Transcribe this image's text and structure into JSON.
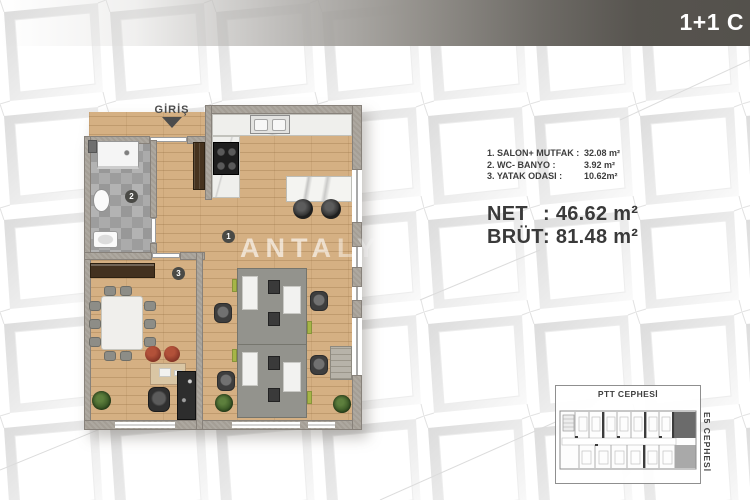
{
  "header": {
    "title": "1+1 C"
  },
  "plan": {
    "entrance_label": "GİRİŞ",
    "watermark": "ANTALYA",
    "markers": [
      {
        "number": "1",
        "room": "salon-mutfak"
      },
      {
        "number": "2",
        "room": "wc-banyo"
      },
      {
        "number": "3",
        "room": "yatak-odasi"
      }
    ]
  },
  "info": {
    "rooms": [
      {
        "label": "1. SALON+ MUTFAK :",
        "value": "32.08 m²"
      },
      {
        "label": "2. WC- BANYO :",
        "value": "3.92 m²"
      },
      {
        "label": "3. YATAK ODASI :",
        "value": "10.62m²"
      }
    ],
    "net": {
      "label": "NET",
      "value": ": 46.62 m²"
    },
    "brut": {
      "label": "BRÜT",
      "value": ": 81.48 m²"
    }
  },
  "keyplan": {
    "top_label": "PTT CEPHESİ",
    "right_label": "E5 CEPHESİ"
  },
  "colors": {
    "banner_dark": "#54514c",
    "wood_floor": "#d5b083",
    "wall": "#a49e95",
    "bath_tile": "#a2a2a2",
    "accent_green": "#a6b547",
    "marker": "#4a4a46",
    "text_dark": "#3d3d3d",
    "keyplan_highlight": "#6b6b6b"
  }
}
